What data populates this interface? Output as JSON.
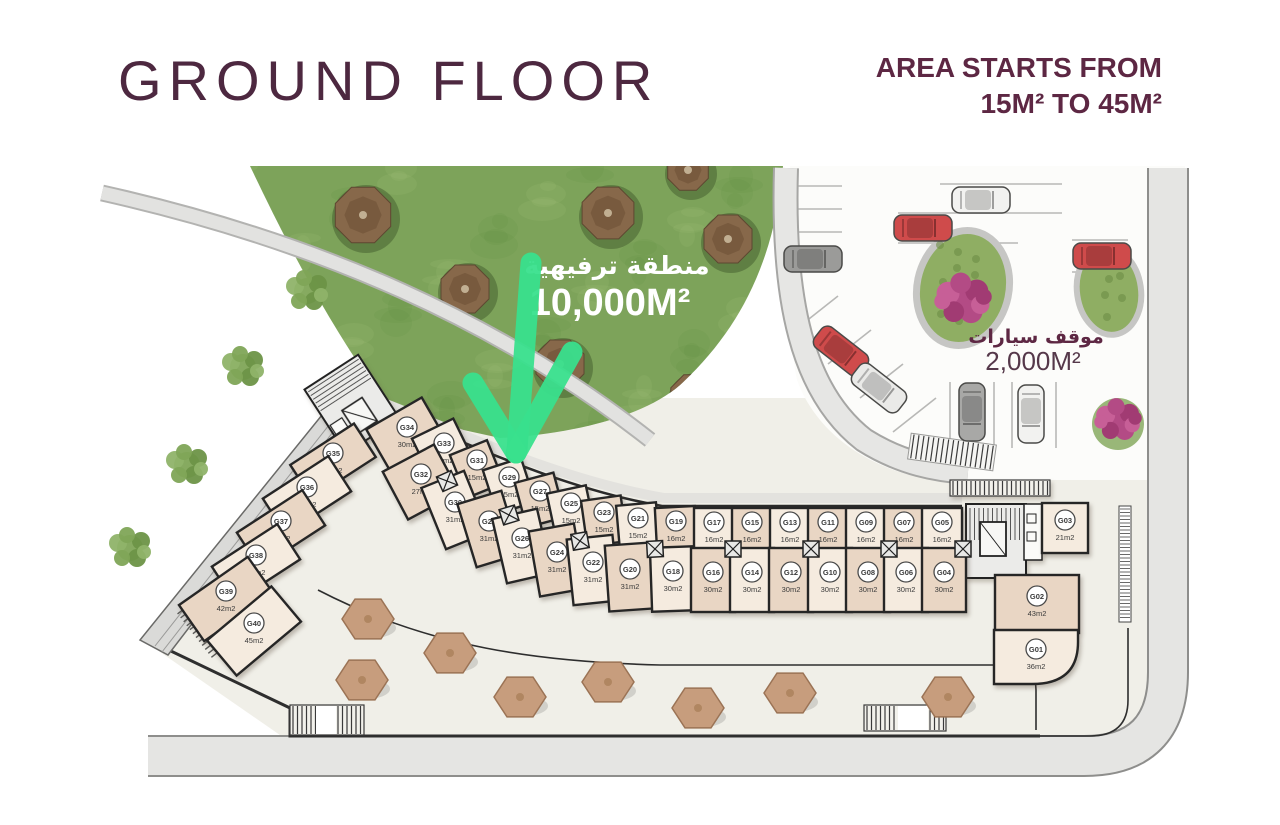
{
  "header": {
    "title": "GROUND FLOOR",
    "area_note_1": "AREA STARTS FROM",
    "area_note_2": "15M² TO 45M²"
  },
  "labels": {
    "recreation_ar": "منطقة ترفيهية",
    "recreation_area": "10,000M²",
    "parking_ar": "موقف سيارات",
    "parking_area": "2,000M²"
  },
  "theme": {
    "maroon": "#5d2743",
    "arrow_green": "#39e08d",
    "unit_fill_a": "#e9d6c4",
    "unit_fill_b": "#f5ebdf",
    "wall": "#262626",
    "lawn": "#7da35a",
    "plaza": "#f0efe8",
    "road": "#e4e4e2",
    "parking_bg": "#fcfcfa"
  },
  "units": [
    [
      "G35",
      "34m2",
      333,
      461,
      76,
      40,
      -33,
      "wing"
    ],
    [
      "G36",
      "37m2",
      307,
      495,
      78,
      42,
      -33,
      "wing"
    ],
    [
      "G37",
      "37m2",
      281,
      529,
      78,
      42,
      -33,
      "wing"
    ],
    [
      "G38",
      "37m2",
      256,
      563,
      78,
      42,
      -33,
      "wing"
    ],
    [
      "G39",
      "42m2",
      226,
      599,
      84,
      44,
      -35,
      "wing"
    ],
    [
      "G40",
      "45m2",
      254,
      631,
      84,
      46,
      -40,
      "wing"
    ],
    [
      "G34",
      "30m2",
      407,
      436,
      64,
      52,
      -30,
      "outer"
    ],
    [
      "G33",
      "18m2",
      444,
      452,
      46,
      52,
      -26,
      "outer"
    ],
    [
      "G31",
      "15m2",
      477,
      469,
      40,
      46,
      -22,
      "outer"
    ],
    [
      "G29",
      "15m2",
      509,
      486,
      40,
      46,
      -18,
      "outer"
    ],
    [
      "G27",
      "15m2",
      540,
      500,
      40,
      46,
      -15,
      "outer"
    ],
    [
      "G25",
      "15m2",
      571,
      512,
      40,
      46,
      -12,
      "outer"
    ],
    [
      "G23",
      "15m2",
      604,
      521,
      40,
      46,
      -8,
      "outer"
    ],
    [
      "G21",
      "15m2",
      638,
      527,
      40,
      46,
      -5,
      "outer"
    ],
    [
      "G19",
      "16m2",
      676,
      530,
      40,
      46,
      -3,
      "outer"
    ],
    [
      "G17",
      "16m2",
      714,
      531,
      40,
      46,
      0,
      "outer"
    ],
    [
      "G15",
      "16m2",
      752,
      531,
      40,
      46,
      0,
      "outer"
    ],
    [
      "G13",
      "16m2",
      790,
      531,
      40,
      46,
      0,
      "outer"
    ],
    [
      "G11",
      "16m2",
      828,
      531,
      40,
      46,
      0,
      "outer"
    ],
    [
      "G09",
      "16m2",
      866,
      531,
      40,
      46,
      0,
      "outer"
    ],
    [
      "G07",
      "16m2",
      904,
      531,
      40,
      46,
      0,
      "outer"
    ],
    [
      "G05",
      "16m2",
      942,
      531,
      40,
      46,
      0,
      "outer"
    ],
    [
      "G32",
      "27m2",
      421,
      482,
      58,
      54,
      -28,
      "inner"
    ],
    [
      "G30",
      "31m2",
      455,
      510,
      46,
      66,
      -22,
      "inner"
    ],
    [
      "G28",
      "31m2",
      489,
      529,
      46,
      66,
      -17,
      "inner"
    ],
    [
      "G26",
      "31m2",
      522,
      546,
      46,
      66,
      -13,
      "inner"
    ],
    [
      "G24",
      "31m2",
      557,
      560,
      46,
      66,
      -10,
      "inner"
    ],
    [
      "G22",
      "31m2",
      593,
      570,
      46,
      66,
      -6,
      "inner"
    ],
    [
      "G20",
      "31m2",
      630,
      577,
      46,
      66,
      -4,
      "inner"
    ],
    [
      "G18",
      "30m2",
      673,
      579,
      44,
      64,
      -2,
      "inner"
    ],
    [
      "G16",
      "30m2",
      713,
      580,
      44,
      64,
      0,
      "inner"
    ],
    [
      "G14",
      "30m2",
      752,
      580,
      44,
      64,
      0,
      "inner"
    ],
    [
      "G12",
      "30m2",
      791,
      580,
      44,
      64,
      0,
      "inner"
    ],
    [
      "G10",
      "30m2",
      830,
      580,
      44,
      64,
      0,
      "inner"
    ],
    [
      "G08",
      "30m2",
      868,
      580,
      44,
      64,
      0,
      "inner"
    ],
    [
      "G06",
      "30m2",
      906,
      580,
      44,
      64,
      0,
      "inner"
    ],
    [
      "G04",
      "30m2",
      944,
      580,
      44,
      64,
      0,
      "inner"
    ],
    [
      "G03",
      "21m2",
      1065,
      528,
      46,
      50,
      0,
      "east"
    ],
    [
      "G02",
      "43m2",
      1037,
      604,
      84,
      58,
      0,
      "east"
    ],
    [
      "G01",
      "36m2",
      1036,
      657,
      84,
      54,
      0,
      "east-round"
    ]
  ],
  "exit_boxes": [
    [
      447,
      481,
      -24
    ],
    [
      509,
      515,
      -17
    ],
    [
      580,
      541,
      -10
    ],
    [
      655,
      549,
      -3
    ],
    [
      733,
      549,
      0
    ],
    [
      811,
      549,
      0
    ],
    [
      889,
      549,
      0
    ],
    [
      963,
      549,
      0
    ]
  ],
  "umbrellas": [
    [
      368,
      619
    ],
    [
      450,
      653
    ],
    [
      362,
      680
    ],
    [
      520,
      697
    ],
    [
      608,
      682
    ],
    [
      698,
      708
    ],
    [
      790,
      693
    ],
    [
      948,
      697
    ]
  ],
  "lawn_trees": [
    [
      363,
      215,
      30
    ],
    [
      608,
      213,
      28
    ],
    [
      728,
      239,
      26
    ],
    [
      465,
      289,
      26
    ],
    [
      560,
      364,
      26
    ],
    [
      693,
      397,
      24
    ],
    [
      688,
      170,
      22
    ]
  ],
  "bushes": [
    [
      307,
      291
    ],
    [
      243,
      367
    ],
    [
      187,
      465
    ],
    [
      130,
      548
    ]
  ],
  "cars": [
    [
      813,
      259,
      0,
      "#9b9b99"
    ],
    [
      981,
      200,
      0,
      "#f2f2f0"
    ],
    [
      923,
      228,
      0,
      "#cf4b4b"
    ],
    [
      1102,
      256,
      0,
      "#cf4b4b"
    ],
    [
      841,
      351,
      38,
      "#cf4b4b"
    ],
    [
      879,
      388,
      38,
      "#eaeae8"
    ],
    [
      972,
      412,
      90,
      "#a8a8a6"
    ],
    [
      1031,
      414,
      90,
      "#f2f2f0"
    ]
  ],
  "stall_lines": [
    [
      778,
      186,
      842,
      186
    ],
    [
      778,
      209,
      842,
      209
    ],
    [
      778,
      232,
      842,
      232
    ],
    [
      940,
      184,
      1062,
      184
    ],
    [
      898,
      213,
      1062,
      213
    ],
    [
      898,
      243,
      1018,
      243
    ],
    [
      1072,
      240,
      1128,
      240
    ],
    [
      1072,
      272,
      1128,
      272
    ],
    [
      950,
      382,
      950,
      448
    ],
    [
      994,
      382,
      994,
      448
    ],
    [
      1012,
      382,
      1012,
      448
    ],
    [
      1056,
      382,
      1056,
      448
    ],
    [
      795,
      330,
      838,
      296
    ],
    [
      828,
      364,
      871,
      330
    ],
    [
      860,
      398,
      903,
      364
    ],
    [
      893,
      432,
      936,
      398
    ]
  ]
}
